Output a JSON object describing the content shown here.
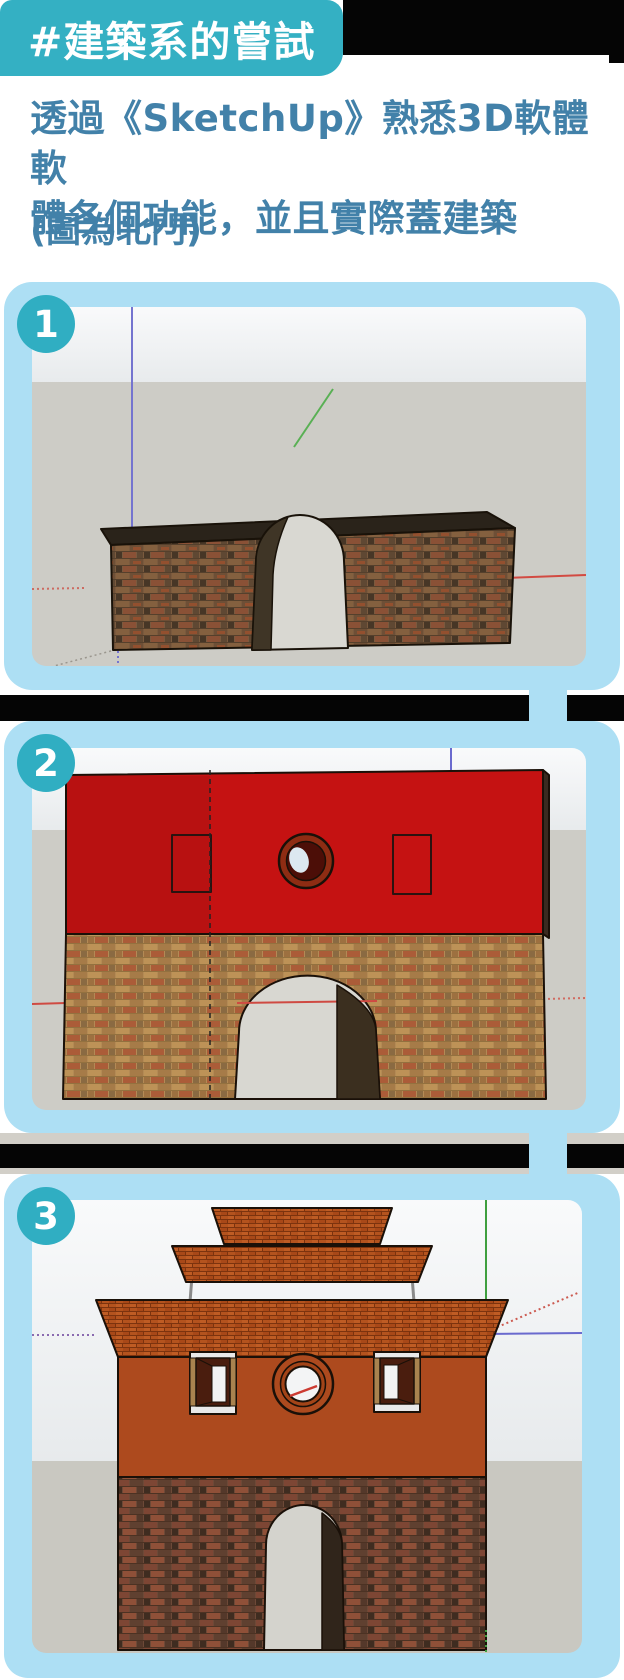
{
  "header": {
    "badge": "#建築系的嘗試",
    "title_line1": "透過《SketchUp》熟悉3D軟體軟",
    "title_line2": "體各個功能，並且實際蓋建築",
    "note": "(圖為北門)"
  },
  "steps": [
    {
      "number": "1",
      "content": "sketchup-brick-box-with-arch"
    },
    {
      "number": "2",
      "content": "sketchup-gate-front-red-top-brick-base"
    },
    {
      "number": "3",
      "content": "sketchup-north-gate-with-tiered-roofs"
    }
  ],
  "colors": {
    "accent_teal": "#34b0c3",
    "heading_blue": "#4281a9",
    "panel_blue": "#addff4",
    "separator_black": "#050505",
    "sketchup_red_face": "#c41212",
    "wall_orange": "#ad4a1e",
    "sky_gray": "#eef1f3",
    "ground_gray": "#cdccc6"
  }
}
